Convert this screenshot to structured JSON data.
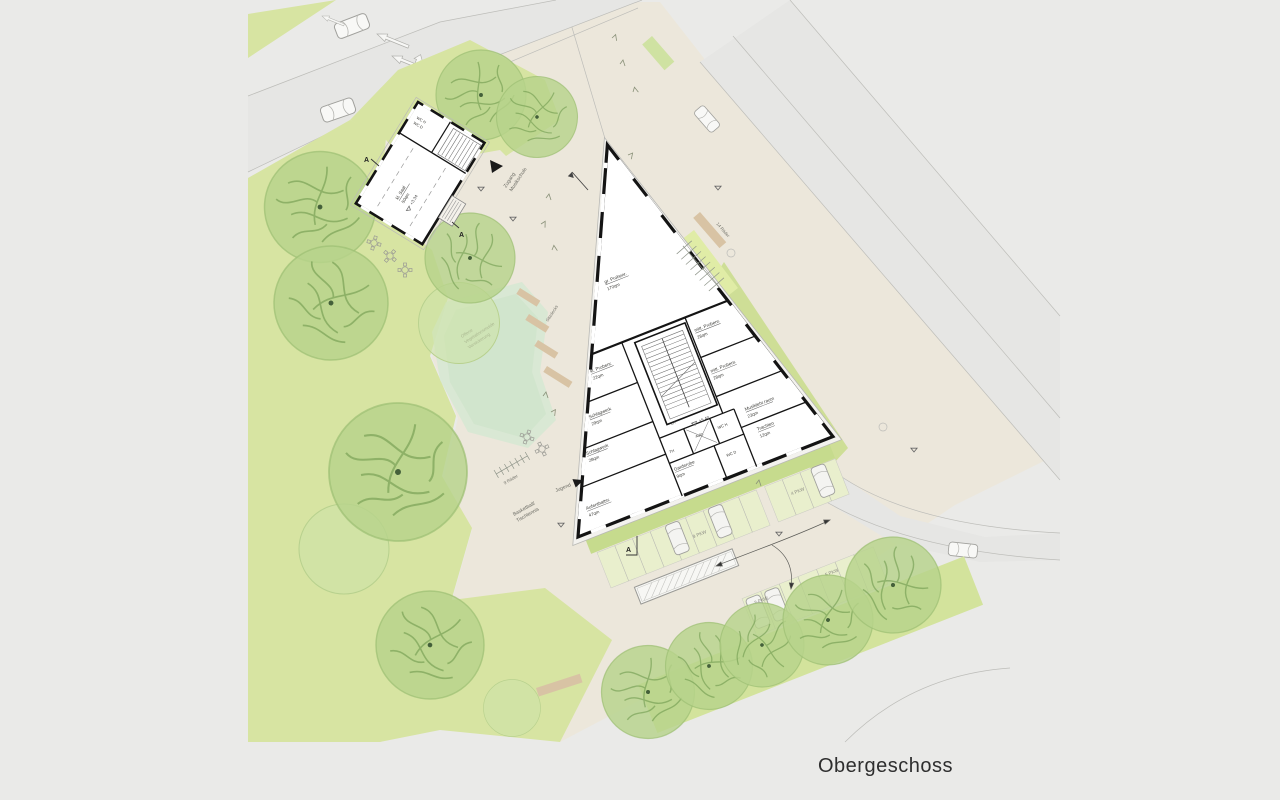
{
  "plan_title": "Obergeschoss",
  "main_building": {
    "level": "+5.40",
    "rooms": [
      {
        "name": "gr. Probenr.",
        "area": "170qm"
      },
      {
        "name": "kl. Probenr.",
        "area": "22qm"
      },
      {
        "name": "mitt. Probenr.",
        "area": "28qm"
      },
      {
        "name": "mitt. Probenr.",
        "area": "28qm"
      },
      {
        "name": "Schlagwerk",
        "area": "29qm"
      },
      {
        "name": "Schlagwerk",
        "area": "28qm"
      },
      {
        "name": "Musiklehr.raum",
        "area": "23qm"
      },
      {
        "name": "Trachten",
        "area": "12qm"
      },
      {
        "name": "Garderobe",
        "area": "9qm"
      },
      {
        "name": "Aufenthaltsr.",
        "area": "47qm"
      }
    ],
    "service_rooms": {
      "stair": "TH",
      "elevator": "Aufz.",
      "wc_men": "WC H",
      "wc_women": "WC D",
      "void": "LR"
    }
  },
  "small_building": {
    "hall_name": "kl. Saal",
    "hall_area": "50qm",
    "level": "+3.34",
    "wc_men": "WC H",
    "wc_women": "WC D"
  },
  "site": {
    "entrance_line_1": "Zugang",
    "entrance_line_2": "Musikschule",
    "youth_entrance": "Jugend",
    "swale_line_1": "Offene",
    "swale_line_2": "Vegetationsmulde",
    "swale_line_3": "Versickerung",
    "seating": "Sitzdecks",
    "sport_line_1": "Basketball/",
    "sport_line_2": "Tischtennis",
    "bikes_small": "9 Räder",
    "bikes_large": "14 Räder",
    "parking_row_1": "9 PKW",
    "parking_row_2": "4 PKW",
    "parking_row_3": "5 PKW",
    "parking_row_4": "2 PKW",
    "section_marker": "A"
  },
  "colors": {
    "background": "#eaeae8",
    "paving": "#ece7db",
    "lawn": "#d7e4a2",
    "tree": "#b7d38b",
    "swale": "#d6e8d2",
    "road": "#e6e6e4",
    "hedge": "#c6db8d",
    "deck": "#d8c3a4",
    "wall": "#141414"
  }
}
